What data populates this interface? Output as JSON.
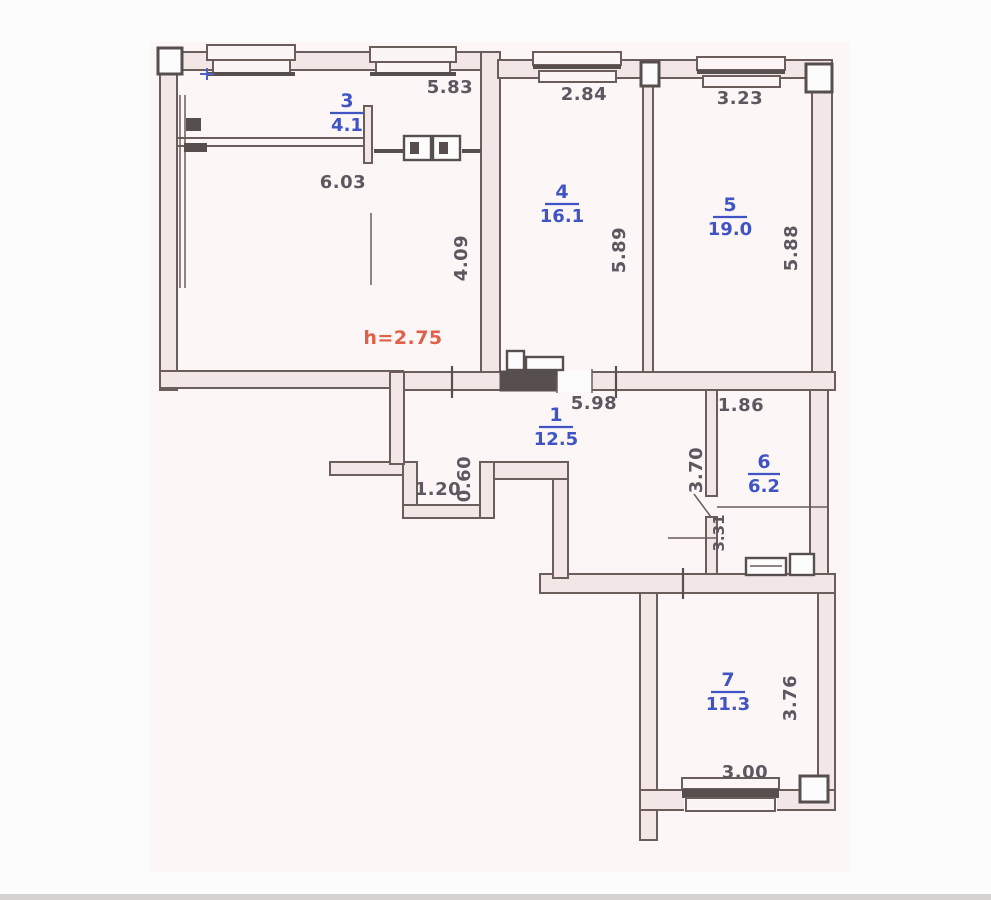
{
  "document_type": "apartment-floor-plan-scan",
  "colors": {
    "room_label": "#4054c4",
    "dimension_text": "#5d5760",
    "height_note": "#e0604a",
    "wall_outline": "#6a5d5a",
    "wall_fill": "#f3e6e6"
  },
  "height_note": "h=2.75",
  "rooms": [
    {
      "num": "1",
      "area": "12.5"
    },
    {
      "num": "3",
      "area": "4.1"
    },
    {
      "num": "4",
      "area": "16.1"
    },
    {
      "num": "5",
      "area": "19.0"
    },
    {
      "num": "6",
      "area": "6.2"
    },
    {
      "num": "7",
      "area": "11.3"
    }
  ],
  "dimensions": {
    "big_room_top": "5.83",
    "big_room_width": "6.03",
    "big_room_right": "4.09",
    "room4_top": "2.84",
    "room4_right": "5.89",
    "room5_top": "3.23",
    "room5_right": "5.88",
    "hall_top": "5.98",
    "room6_top": "1.86",
    "room6_left": "3.70",
    "bath_left": "3.31",
    "niche_width": "1.20",
    "niche_depth": "0.60",
    "room7_right": "3.76",
    "room7_bottom": "3.00"
  }
}
